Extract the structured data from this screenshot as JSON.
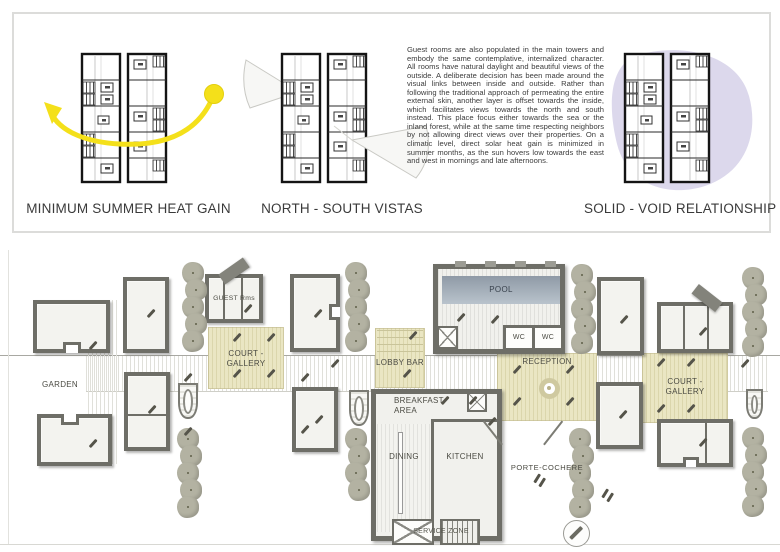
{
  "concept_panel": {
    "diagram_1_label": "MINIMUM SUMMER HEAT GAIN",
    "diagram_2_label": "NORTH - SOUTH VISTAS",
    "diagram_3_label": "SOLID - VOID RELATIONSHIP",
    "description": "Guest rooms are also populated in the main towers and embody the same contemplative, internalized character. All rooms have natural daylight and beautiful views of the outside. A deliberate decision has been made around the visual links between inside and outside. Rather than following the traditional approach of permeating the entire external skin, another layer is offset towards the inside, which facilitates views towards the north and south instead. This place focus either towards the sea or the inland forest, while at the same time respecting neighbors by not allowing direct views over their properties. On a climatic level, direct solar heat gain is minimized in summer months, as the sun hovers low towards the east and west in mornings and late afternoons."
  },
  "site_plan": {
    "rooms": {
      "guest_rooms": "GUEST Rms",
      "garden": "GARDEN",
      "court_gallery_left_line1": "COURT -",
      "court_gallery_left_line2": "GALLERY",
      "lobby_bar": "LOBBY BAR",
      "pool": "POOL",
      "wc_left": "WC",
      "wc_right": "WC",
      "reception": "RECEPTION",
      "breakfast_line1": "BREAKFAST",
      "breakfast_line2": "AREA",
      "dining": "DINING",
      "kitchen": "KITCHEN",
      "service_zone": "SERVICE ZONE",
      "porte_cochere": "PORTE-COCHERE",
      "court_gallery_right_line1": "COURT -",
      "court_gallery_right_line2": "GALLERY"
    }
  },
  "icons": {
    "sun": "sun-icon",
    "sun_path": "sun-path-arrow-icon",
    "view_cone": "view-cone-icon",
    "void_blob": "void-blob-icon",
    "north_compass": "compass-icon",
    "tree": "tree-icon",
    "fountain": "fountain-icon"
  },
  "colors": {
    "court_fill": "#eae6c3",
    "pool_fill": "#a9b3bd",
    "tree_fill": "#b3b2a2",
    "wall": "#6e6e67",
    "sun_yellow": "#f4e01a",
    "void_lavender": "#dcd8ec"
  }
}
